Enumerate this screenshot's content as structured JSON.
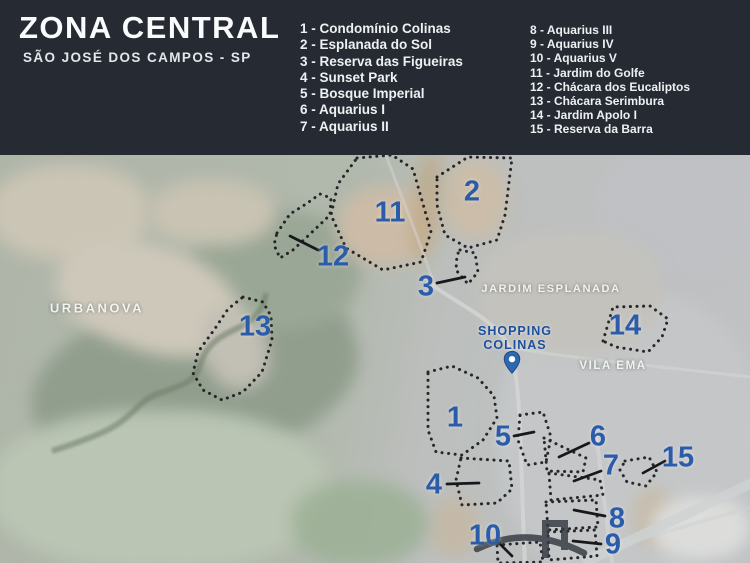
{
  "header": {
    "title": "ZONA CENTRAL",
    "subtitle": "SÃO JOSÉ DOS CAMPOS - SP",
    "legend_col1": [
      "1 - Condomínio Colinas",
      "2 - Esplanada do Sol",
      "3 - Reserva das Figueiras",
      "4 - Sunset Park",
      "5 - Bosque Imperial",
      "6 - Aquarius I",
      "7 - Aquarius II"
    ],
    "legend_col2": [
      "8 - Aquarius III",
      "9 - Aquarius IV",
      "10 - Aquarius V",
      "11 - Jardim do Golfe",
      "12 - Chácara dos Eucaliptos",
      "13 - Chácara Serimbura",
      "14 - Jardim Apolo I",
      "15 - Reserva da Barra"
    ]
  },
  "map": {
    "labels": {
      "urbanova": "URBANOVA",
      "jardim_esplanada": "JARDIM ESPLANADA",
      "vila_ema": "VILA EMA",
      "shopping_line1": "SHOPPING",
      "shopping_line2": "COLINAS"
    },
    "markers": [
      "1",
      "2",
      "3",
      "4",
      "5",
      "6",
      "7",
      "8",
      "9",
      "10",
      "11",
      "12",
      "13",
      "14",
      "15"
    ]
  },
  "colors": {
    "header_bg": "#262b33",
    "marker_blue": "#2b5ca9",
    "shopping_blue": "#1d509c",
    "map_label_white": "#f1f3f1"
  }
}
